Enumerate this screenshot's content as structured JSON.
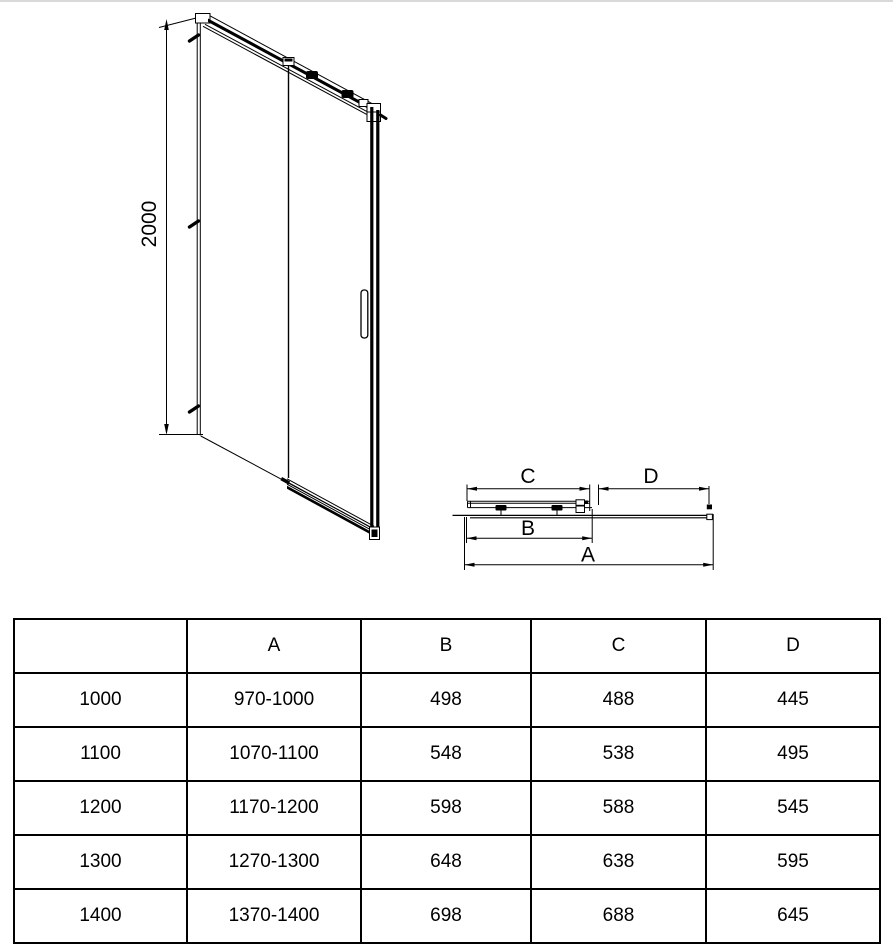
{
  "drawing": {
    "front_view": {
      "height_label": "2000"
    },
    "plan_view": {
      "dim_c": "C",
      "dim_d": "D",
      "dim_b": "B",
      "dim_a": "A"
    }
  },
  "table": {
    "columns": [
      "",
      "A",
      "B",
      "C",
      "D"
    ],
    "rows": [
      [
        "1000",
        "970-1000",
        "498",
        "488",
        "445"
      ],
      [
        "1100",
        "1070-1100",
        "548",
        "538",
        "495"
      ],
      [
        "1200",
        "1170-1200",
        "598",
        "588",
        "545"
      ],
      [
        "1300",
        "1270-1300",
        "648",
        "638",
        "595"
      ],
      [
        "1400",
        "1370-1400",
        "698",
        "688",
        "645"
      ]
    ]
  },
  "colors": {
    "line": "#000000",
    "background": "#ffffff",
    "top_edge": "#d9d9d9"
  }
}
